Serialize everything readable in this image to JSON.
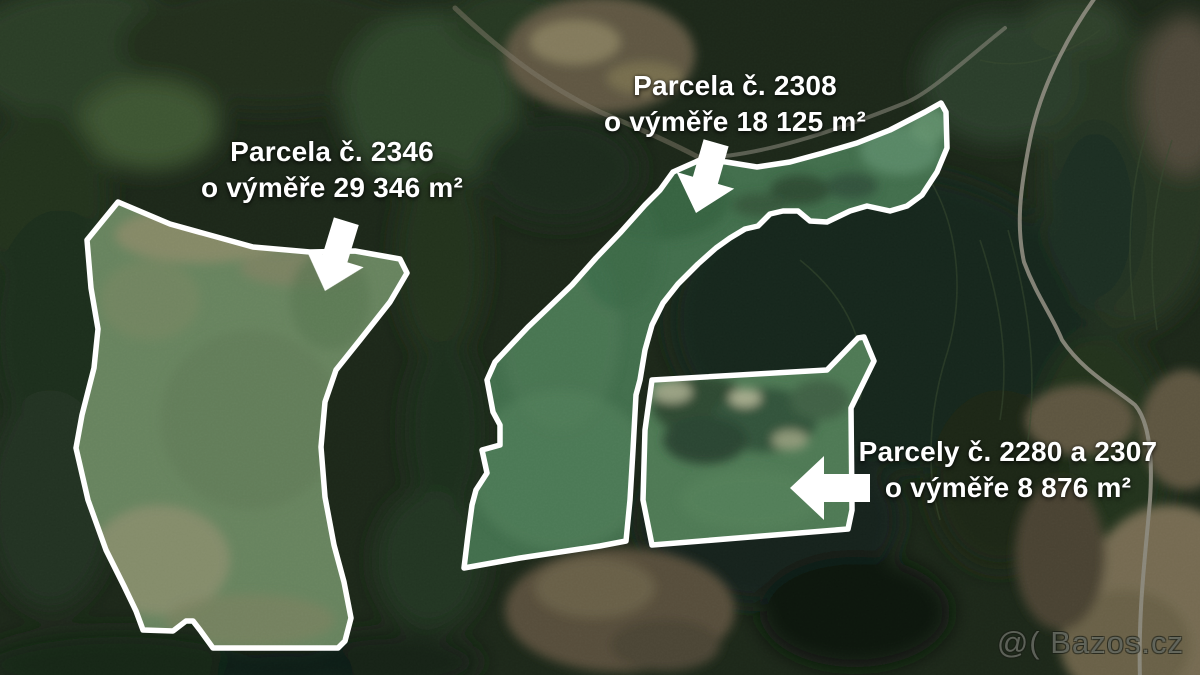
{
  "annotations": {
    "parcel_2346": {
      "line1": "Parcela č. 2346",
      "line2": "o výměře 29 346 m²"
    },
    "parcel_2308": {
      "line1": "Parcela č. 2308",
      "line2": "o výměře 18 125 m²"
    },
    "parcels_2280_2307": {
      "line1": "Parcely č. 2280 a 2307",
      "line2": "o výměře 8 876 m²"
    }
  },
  "watermark": {
    "text": "@( Bazos.cz"
  },
  "colors": {
    "outline": "#ffffff",
    "arrow": "#ffffff",
    "annotation_text": "#ffffff",
    "parcel_2346_field": "#67835e",
    "parcel_2308_field": "#426e4c",
    "parcels_2280_2307_field": "#4e7954",
    "forest_dark": "#1c2719",
    "road": "#8d8b7e"
  }
}
